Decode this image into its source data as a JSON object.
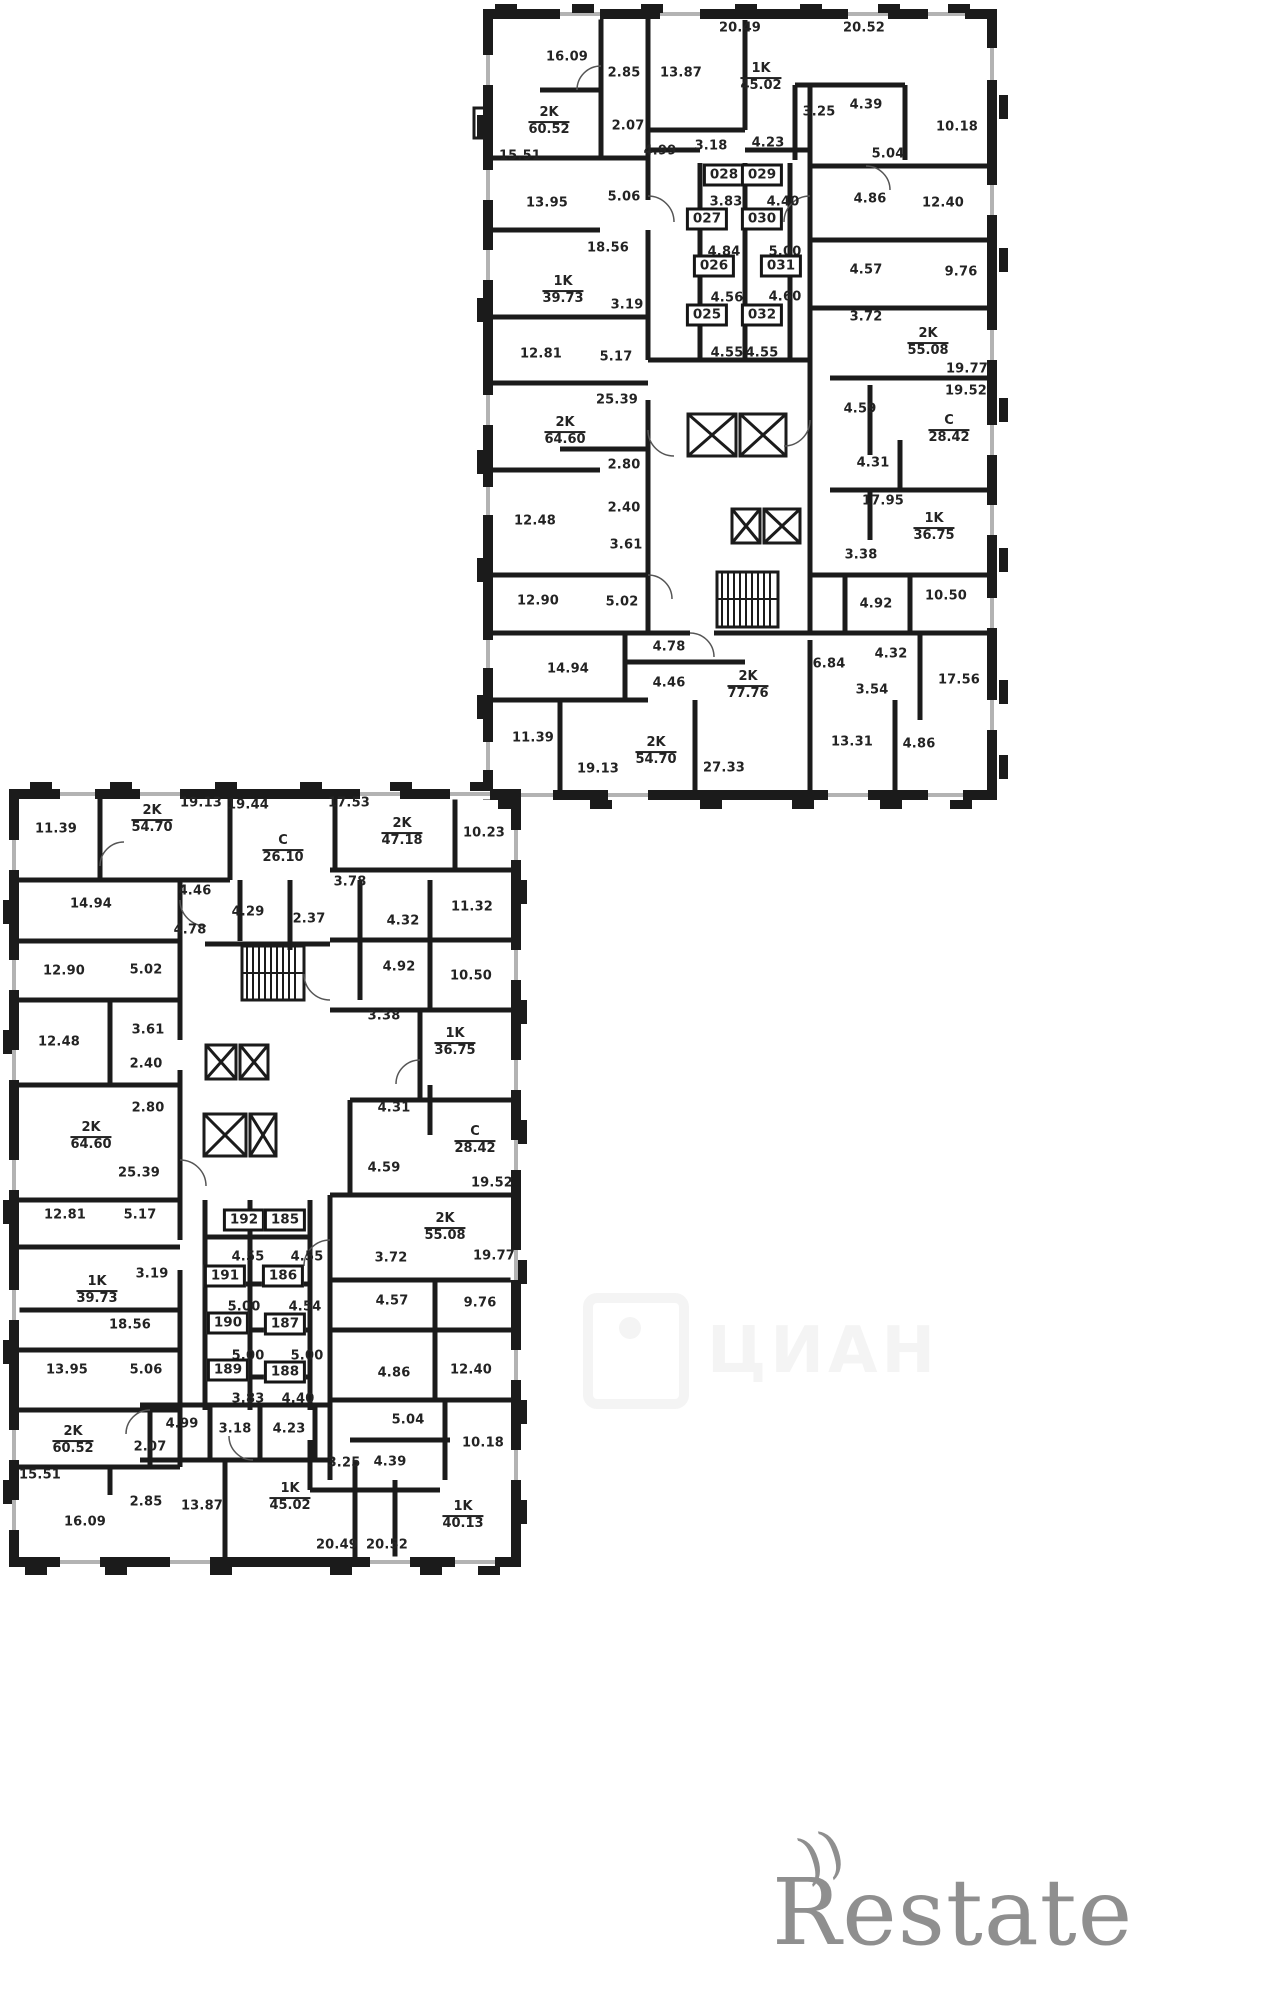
{
  "watermarks": {
    "cian": "ЦИАН",
    "restate": "Restate",
    "restate_mark": "))"
  },
  "plans": [
    {
      "name": "upper-floor-plan",
      "labels": [
        [
          "num",
          "20.49",
          740,
          28
        ],
        [
          "num",
          "20.52",
          864,
          28
        ],
        [
          "num",
          "16.09",
          567,
          57
        ],
        [
          "num",
          "2.85",
          624,
          73
        ],
        [
          "num",
          "13.87",
          681,
          73
        ],
        [
          "unit",
          "1K|45.02",
          761,
          78
        ],
        [
          "unit",
          "2K|60.52",
          549,
          122
        ],
        [
          "num",
          "2.07",
          628,
          126
        ],
        [
          "num",
          "4.99",
          660,
          151
        ],
        [
          "num",
          "3.18",
          711,
          146
        ],
        [
          "num",
          "4.23",
          768,
          143
        ],
        [
          "num",
          "3.25",
          819,
          112
        ],
        [
          "num",
          "4.39",
          866,
          105
        ],
        [
          "num",
          "10.18",
          957,
          127
        ],
        [
          "num",
          "5.04",
          888,
          154
        ],
        [
          "num",
          "15.51",
          520,
          156
        ],
        [
          "num",
          "13.95",
          547,
          203
        ],
        [
          "num",
          "5.06",
          624,
          197
        ],
        [
          "box",
          "028",
          724,
          175
        ],
        [
          "box",
          "029",
          762,
          175
        ],
        [
          "num",
          "3.83",
          726,
          202
        ],
        [
          "num",
          "4.40",
          783,
          202
        ],
        [
          "num",
          "4.86",
          870,
          199
        ],
        [
          "num",
          "12.40",
          943,
          203
        ],
        [
          "box",
          "027",
          707,
          219
        ],
        [
          "box",
          "030",
          762,
          219
        ],
        [
          "num",
          "18.56",
          608,
          248
        ],
        [
          "num",
          "4.84",
          724,
          252
        ],
        [
          "num",
          "5.00",
          785,
          252
        ],
        [
          "num",
          "4.57",
          866,
          270
        ],
        [
          "num",
          "9.76",
          961,
          272
        ],
        [
          "box",
          "026",
          714,
          266
        ],
        [
          "box",
          "031",
          781,
          266
        ],
        [
          "unit",
          "1K|39.73",
          563,
          291
        ],
        [
          "num",
          "3.19",
          627,
          305
        ],
        [
          "num",
          "4.56",
          727,
          298
        ],
        [
          "num",
          "4.60",
          785,
          297
        ],
        [
          "num",
          "3.72",
          866,
          317
        ],
        [
          "unit",
          "2K|55.08",
          928,
          343
        ],
        [
          "box",
          "025",
          707,
          315
        ],
        [
          "box",
          "032",
          762,
          315
        ],
        [
          "num",
          "12.81",
          541,
          354
        ],
        [
          "num",
          "5.17",
          616,
          357
        ],
        [
          "num",
          "4.55",
          727,
          353
        ],
        [
          "num",
          "4.55",
          762,
          353
        ],
        [
          "num",
          "19.77",
          967,
          369
        ],
        [
          "num",
          "19.52",
          966,
          391
        ],
        [
          "num",
          "25.39",
          617,
          400
        ],
        [
          "num",
          "4.59",
          860,
          409
        ],
        [
          "unit",
          "C|28.42",
          949,
          430
        ],
        [
          "unit",
          "2K|64.60",
          565,
          432
        ],
        [
          "num",
          "4.31",
          873,
          463
        ],
        [
          "num",
          "2.80",
          624,
          465
        ],
        [
          "num",
          "2.40",
          624,
          508
        ],
        [
          "num",
          "12.48",
          535,
          521
        ],
        [
          "num",
          "3.61",
          626,
          545
        ],
        [
          "num",
          "17.95",
          883,
          501
        ],
        [
          "unit",
          "1K|36.75",
          934,
          528
        ],
        [
          "num",
          "3.38",
          861,
          555
        ],
        [
          "num",
          "12.90",
          538,
          601
        ],
        [
          "num",
          "5.02",
          622,
          602
        ],
        [
          "num",
          "4.92",
          876,
          604
        ],
        [
          "num",
          "10.50",
          946,
          596
        ],
        [
          "num",
          "4.78",
          669,
          647
        ],
        [
          "num",
          "6.84",
          829,
          664
        ],
        [
          "num",
          "4.32",
          891,
          654
        ],
        [
          "num",
          "14.94",
          568,
          669
        ],
        [
          "num",
          "4.46",
          669,
          683
        ],
        [
          "unit",
          "2K|77.76",
          748,
          686
        ],
        [
          "num",
          "17.56",
          959,
          680
        ],
        [
          "num",
          "3.54",
          872,
          690
        ],
        [
          "num",
          "11.39",
          533,
          738
        ],
        [
          "num",
          "13.31",
          852,
          742
        ],
        [
          "num",
          "4.86",
          919,
          744
        ],
        [
          "num",
          "19.13",
          598,
          769
        ],
        [
          "unit",
          "2K|54.70",
          656,
          752
        ],
        [
          "num",
          "27.33",
          724,
          768
        ]
      ]
    },
    {
      "name": "lower-floor-plan",
      "labels": [
        [
          "num",
          "19.13",
          201,
          803
        ],
        [
          "num",
          "19.44",
          248,
          805
        ],
        [
          "num",
          "17.53",
          349,
          803
        ],
        [
          "num",
          "11.39",
          56,
          829
        ],
        [
          "unit",
          "2K|54.70",
          152,
          820
        ],
        [
          "unit",
          "C|26.10",
          283,
          850
        ],
        [
          "unit",
          "2K|47.18",
          402,
          833
        ],
        [
          "num",
          "10.23",
          484,
          833
        ],
        [
          "num",
          "14.94",
          91,
          904
        ],
        [
          "num",
          "4.46",
          195,
          891
        ],
        [
          "num",
          "3.78",
          350,
          882
        ],
        [
          "num",
          "4.29",
          248,
          912
        ],
        [
          "num",
          "2.37",
          309,
          919
        ],
        [
          "num",
          "4.32",
          403,
          921
        ],
        [
          "num",
          "11.32",
          472,
          907
        ],
        [
          "num",
          "4.78",
          190,
          930
        ],
        [
          "num",
          "12.90",
          64,
          971
        ],
        [
          "num",
          "5.02",
          146,
          970
        ],
        [
          "num",
          "4.92",
          399,
          967
        ],
        [
          "num",
          "10.50",
          471,
          976
        ],
        [
          "num",
          "3.61",
          148,
          1030
        ],
        [
          "num",
          "12.48",
          59,
          1042
        ],
        [
          "num",
          "3.38",
          384,
          1016
        ],
        [
          "unit",
          "1K|36.75",
          455,
          1043
        ],
        [
          "num",
          "2.40",
          146,
          1064
        ],
        [
          "num",
          "2.80",
          148,
          1108
        ],
        [
          "num",
          "4.31",
          394,
          1108
        ],
        [
          "unit",
          "2K|64.60",
          91,
          1137
        ],
        [
          "unit",
          "C|28.42",
          475,
          1141
        ],
        [
          "num",
          "4.59",
          384,
          1168
        ],
        [
          "num",
          "25.39",
          139,
          1173
        ],
        [
          "num",
          "19.52",
          492,
          1183
        ],
        [
          "num",
          "12.81",
          65,
          1215
        ],
        [
          "num",
          "5.17",
          140,
          1215
        ],
        [
          "box",
          "192",
          244,
          1220
        ],
        [
          "box",
          "185",
          285,
          1220
        ],
        [
          "unit",
          "2K|55.08",
          445,
          1228
        ],
        [
          "num",
          "4.55",
          248,
          1257
        ],
        [
          "num",
          "4.55",
          307,
          1257
        ],
        [
          "num",
          "3.72",
          391,
          1258
        ],
        [
          "num",
          "19.77",
          494,
          1256
        ],
        [
          "box",
          "191",
          225,
          1276
        ],
        [
          "box",
          "186",
          283,
          1276
        ],
        [
          "num",
          "3.19",
          152,
          1274
        ],
        [
          "unit",
          "1K|39.73",
          97,
          1291
        ],
        [
          "num",
          "5.00",
          244,
          1307
        ],
        [
          "num",
          "4.54",
          305,
          1307
        ],
        [
          "num",
          "4.57",
          392,
          1301
        ],
        [
          "num",
          "9.76",
          480,
          1303
        ],
        [
          "num",
          "18.56",
          130,
          1325
        ],
        [
          "box",
          "190",
          228,
          1323
        ],
        [
          "box",
          "187",
          285,
          1324
        ],
        [
          "num",
          "5.00",
          248,
          1356
        ],
        [
          "num",
          "5.00",
          307,
          1356
        ],
        [
          "num",
          "13.95",
          67,
          1370
        ],
        [
          "num",
          "5.06",
          146,
          1370
        ],
        [
          "box",
          "189",
          228,
          1370
        ],
        [
          "box",
          "188",
          285,
          1372
        ],
        [
          "num",
          "4.86",
          394,
          1373
        ],
        [
          "num",
          "12.40",
          471,
          1370
        ],
        [
          "num",
          "3.83",
          248,
          1399
        ],
        [
          "num",
          "4.40",
          298,
          1399
        ],
        [
          "num",
          "4.99",
          182,
          1424
        ],
        [
          "num",
          "3.18",
          235,
          1429
        ],
        [
          "num",
          "4.23",
          289,
          1429
        ],
        [
          "num",
          "5.04",
          408,
          1420
        ],
        [
          "unit",
          "2K|60.52",
          73,
          1441
        ],
        [
          "num",
          "2.07",
          150,
          1447
        ],
        [
          "num",
          "15.51",
          40,
          1475
        ],
        [
          "num",
          "3.25",
          344,
          1463
        ],
        [
          "num",
          "4.39",
          390,
          1462
        ],
        [
          "num",
          "10.18",
          483,
          1443
        ],
        [
          "num",
          "2.85",
          146,
          1502
        ],
        [
          "num",
          "16.09",
          85,
          1522
        ],
        [
          "num",
          "13.87",
          202,
          1506
        ],
        [
          "unit",
          "1K|45.02",
          290,
          1498
        ],
        [
          "unit",
          "1K|40.13",
          463,
          1516
        ],
        [
          "num",
          "20.49",
          337,
          1545
        ],
        [
          "num",
          "20.52",
          387,
          1545
        ]
      ]
    }
  ]
}
